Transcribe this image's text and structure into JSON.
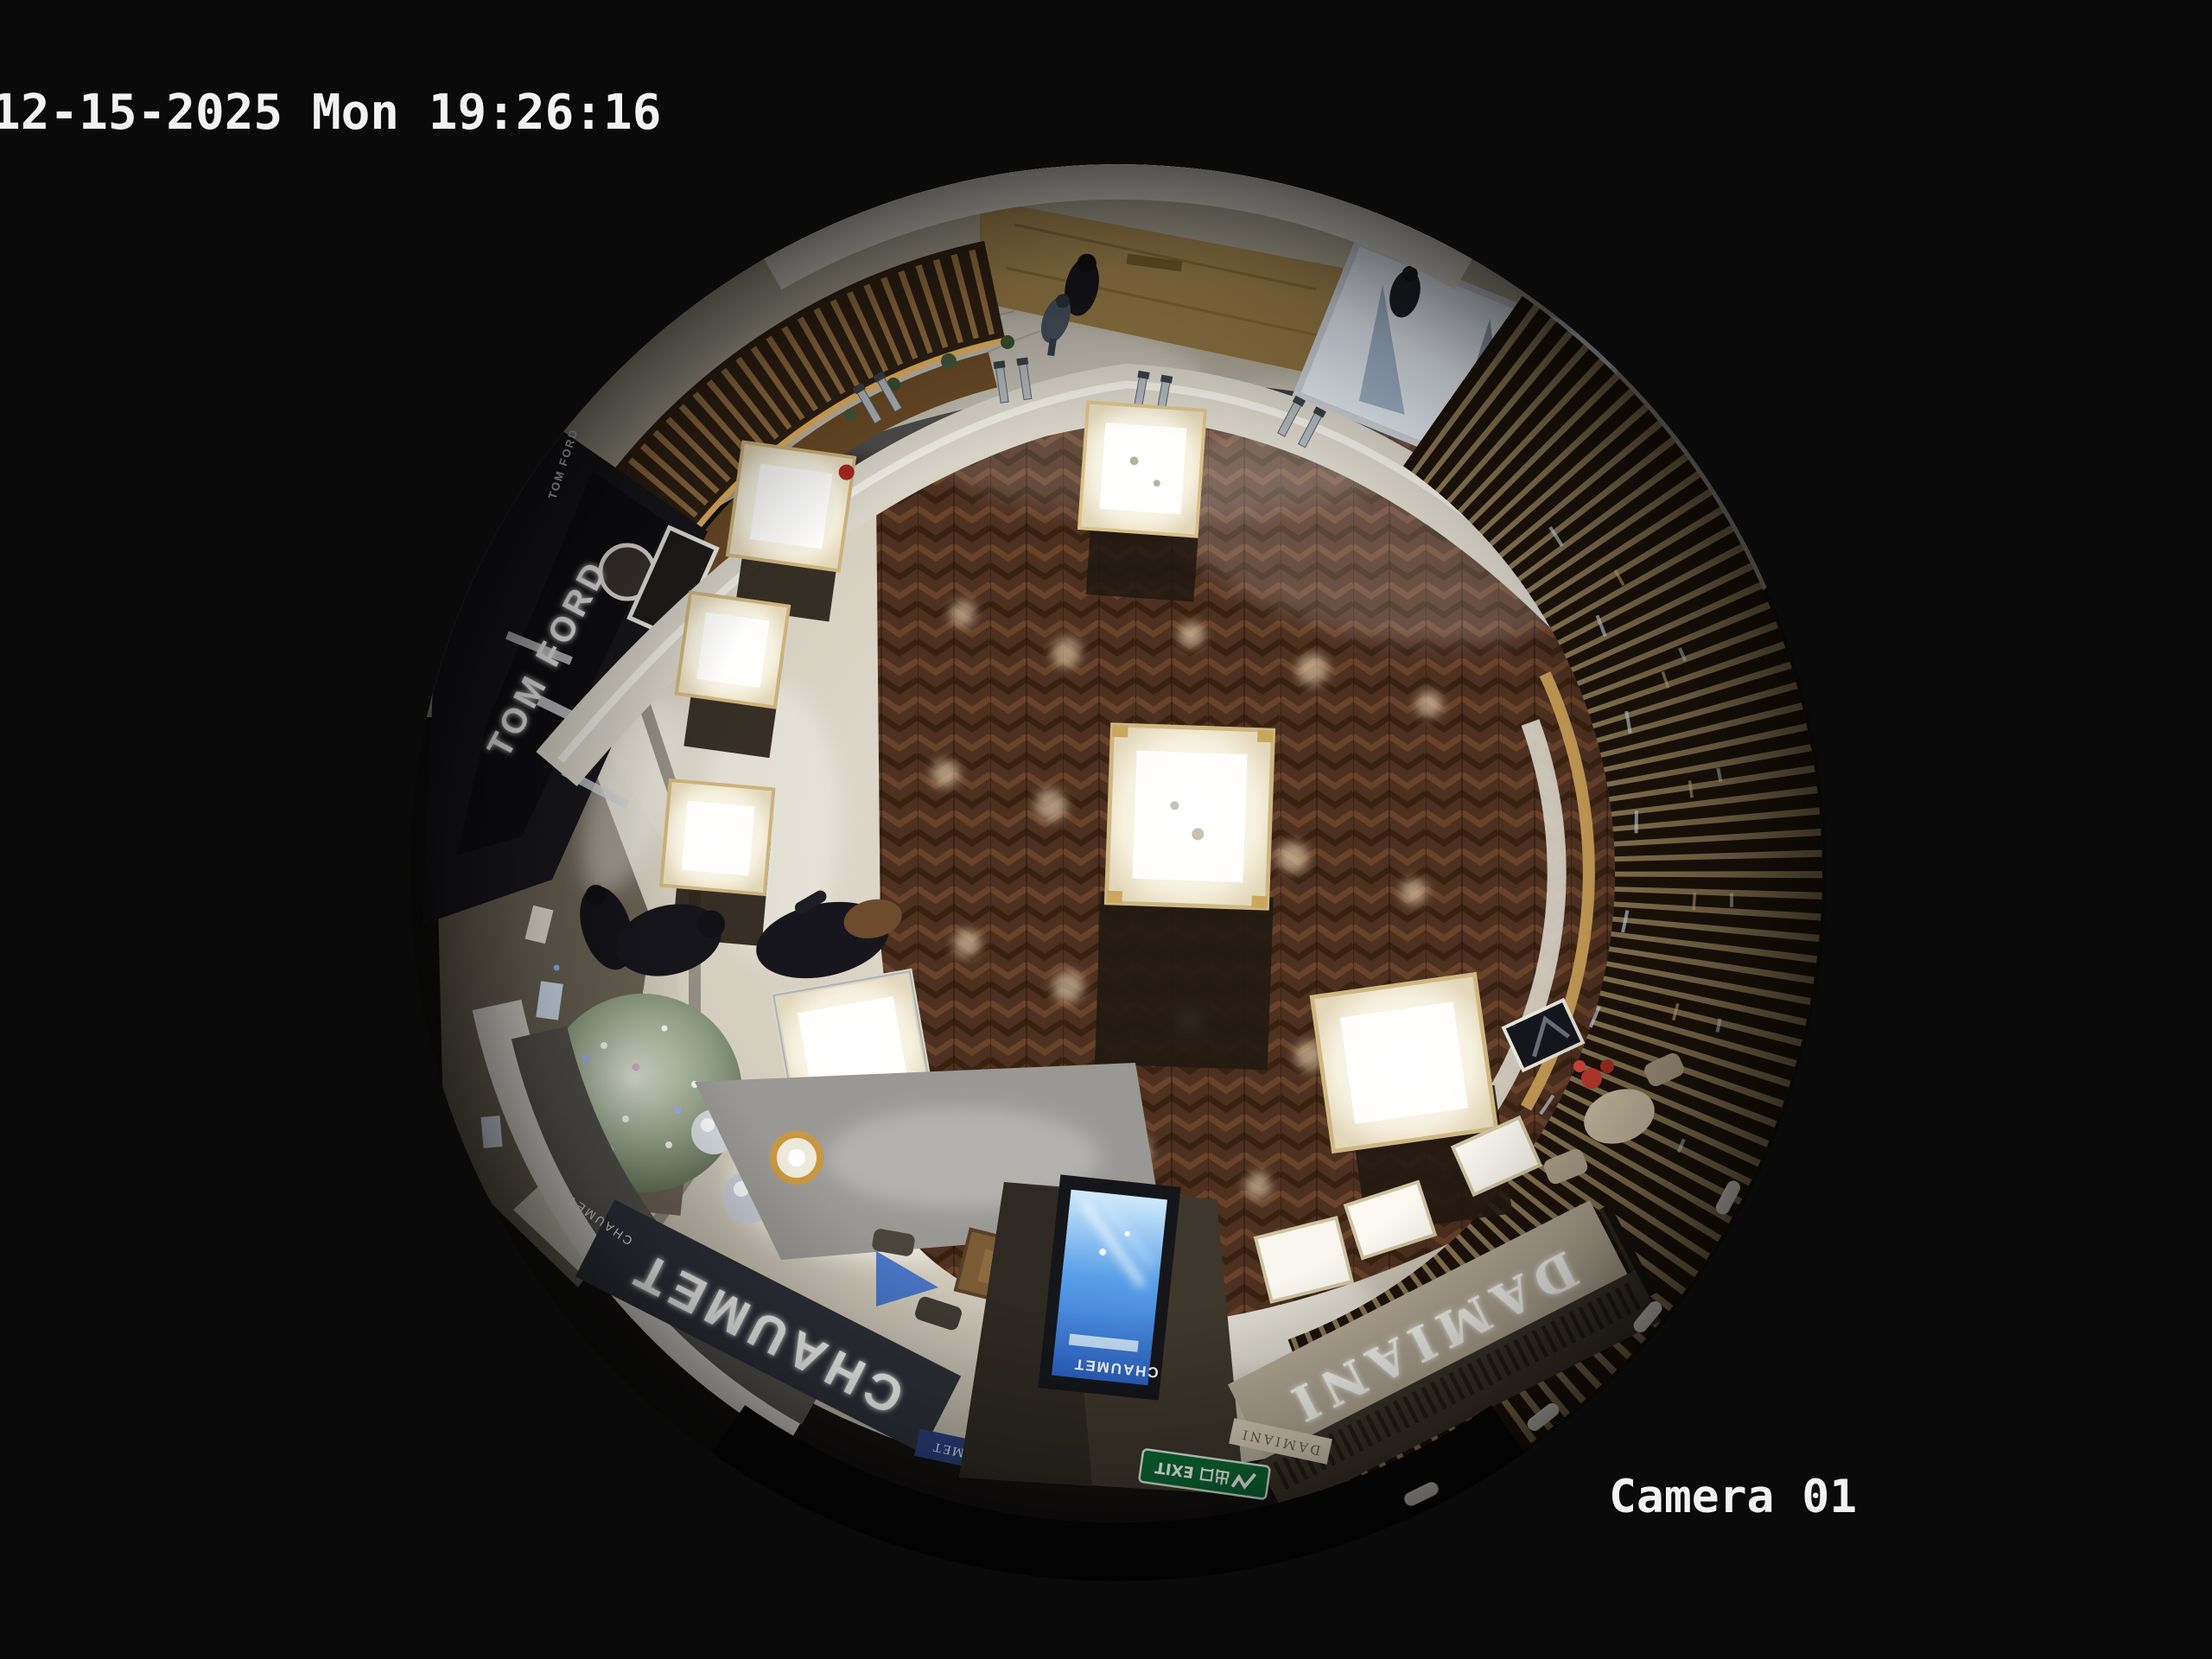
{
  "overlay": {
    "timestamp": "12-15-2025 Mon 19:26:16",
    "camera_label": "Camera 01"
  },
  "signs": {
    "tom_ford": "TOM FORD",
    "tom_ford_small": "TOM FORD",
    "chaumet_fascia": "CHAUMET",
    "chaumet_small": "CHAUMET",
    "chaumet_screen": "CHAUMET",
    "chaumet_plaque": "CHAUMET",
    "damiani_fascia": "DAMIANI",
    "damiani_small": "DAMIANI",
    "exit_label": "出口 EXIT"
  },
  "colors": {
    "background": "#0a0a0a",
    "osd_text": "#f2f2f2",
    "wood_floor": "#4e3020",
    "marble_walkway": "#d6d1c3",
    "corridor_floor": "#aba596",
    "gold_wall": "#967b49",
    "kiosk_wood": "#a87f49",
    "tom_ford_fascia": "#0e0e12",
    "chaumet_fascia": "#2c3038",
    "damiani_fascia": "#b5ab97",
    "screen_blue": "#2f6fd0",
    "exit_green": "#0b6b36",
    "sign_text": "#fafaf8",
    "tree": "#8fa086",
    "accent_red": "#b03228"
  }
}
